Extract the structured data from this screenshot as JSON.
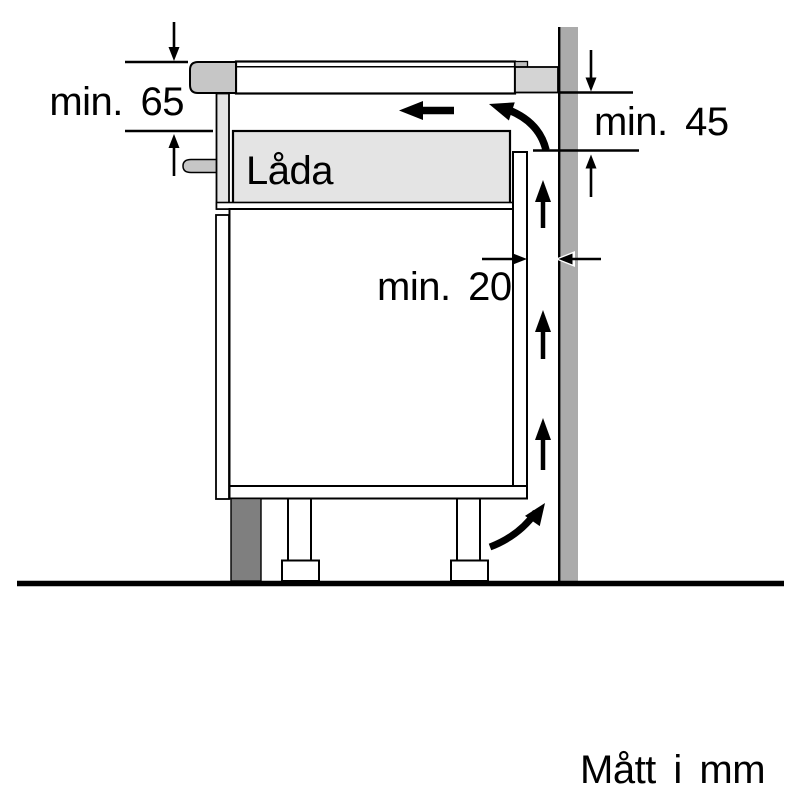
{
  "diagram": {
    "labels": {
      "dim_top_left": "min. 65",
      "dim_top_right": "min. 45",
      "dim_gap": "min. 20",
      "drawer": "Låda",
      "units_note": "Mått i mm"
    },
    "colors": {
      "background": "#ffffff",
      "outline": "#000000",
      "wall": "#ababab",
      "plinth": "#7f7f7f",
      "worktop_end_block": "#d4d4d4",
      "hob_trim": "#c6c6c6",
      "hob_lip": "#bfbfbf",
      "drawer_fill": "#e4e4e4",
      "cabinet_fill": "#ffffff"
    }
  }
}
